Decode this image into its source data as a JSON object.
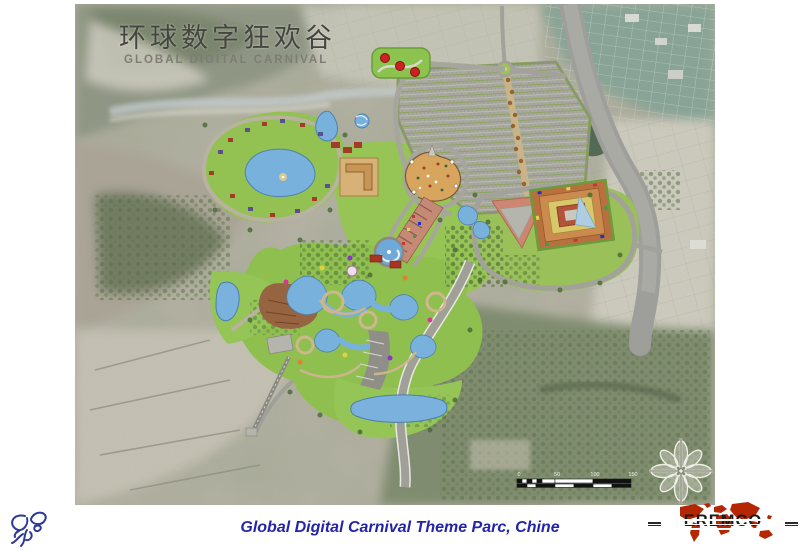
{
  "slide": {
    "background": "#ffffff"
  },
  "map": {
    "title_cn": "环球数字狂欢谷",
    "title_en": "GLOBAL DIGITAL CARNIVAL",
    "scale_bar": {
      "labels": [
        "0",
        "50",
        "100",
        "150"
      ]
    },
    "compass_icon": "compass-rose-icon",
    "content": "aerial-masterplan-theme-park"
  },
  "footer": {
    "caption": "Global Digital Carnival Theme Parc, Chine",
    "caption_color": "#2424a8"
  },
  "logos": {
    "left": {
      "icon": "bee-sketch-icon",
      "color": "#2b3a96"
    },
    "right": {
      "text": "EREMCO",
      "icon": "world-map-icon",
      "map_color": "#b52604"
    }
  }
}
